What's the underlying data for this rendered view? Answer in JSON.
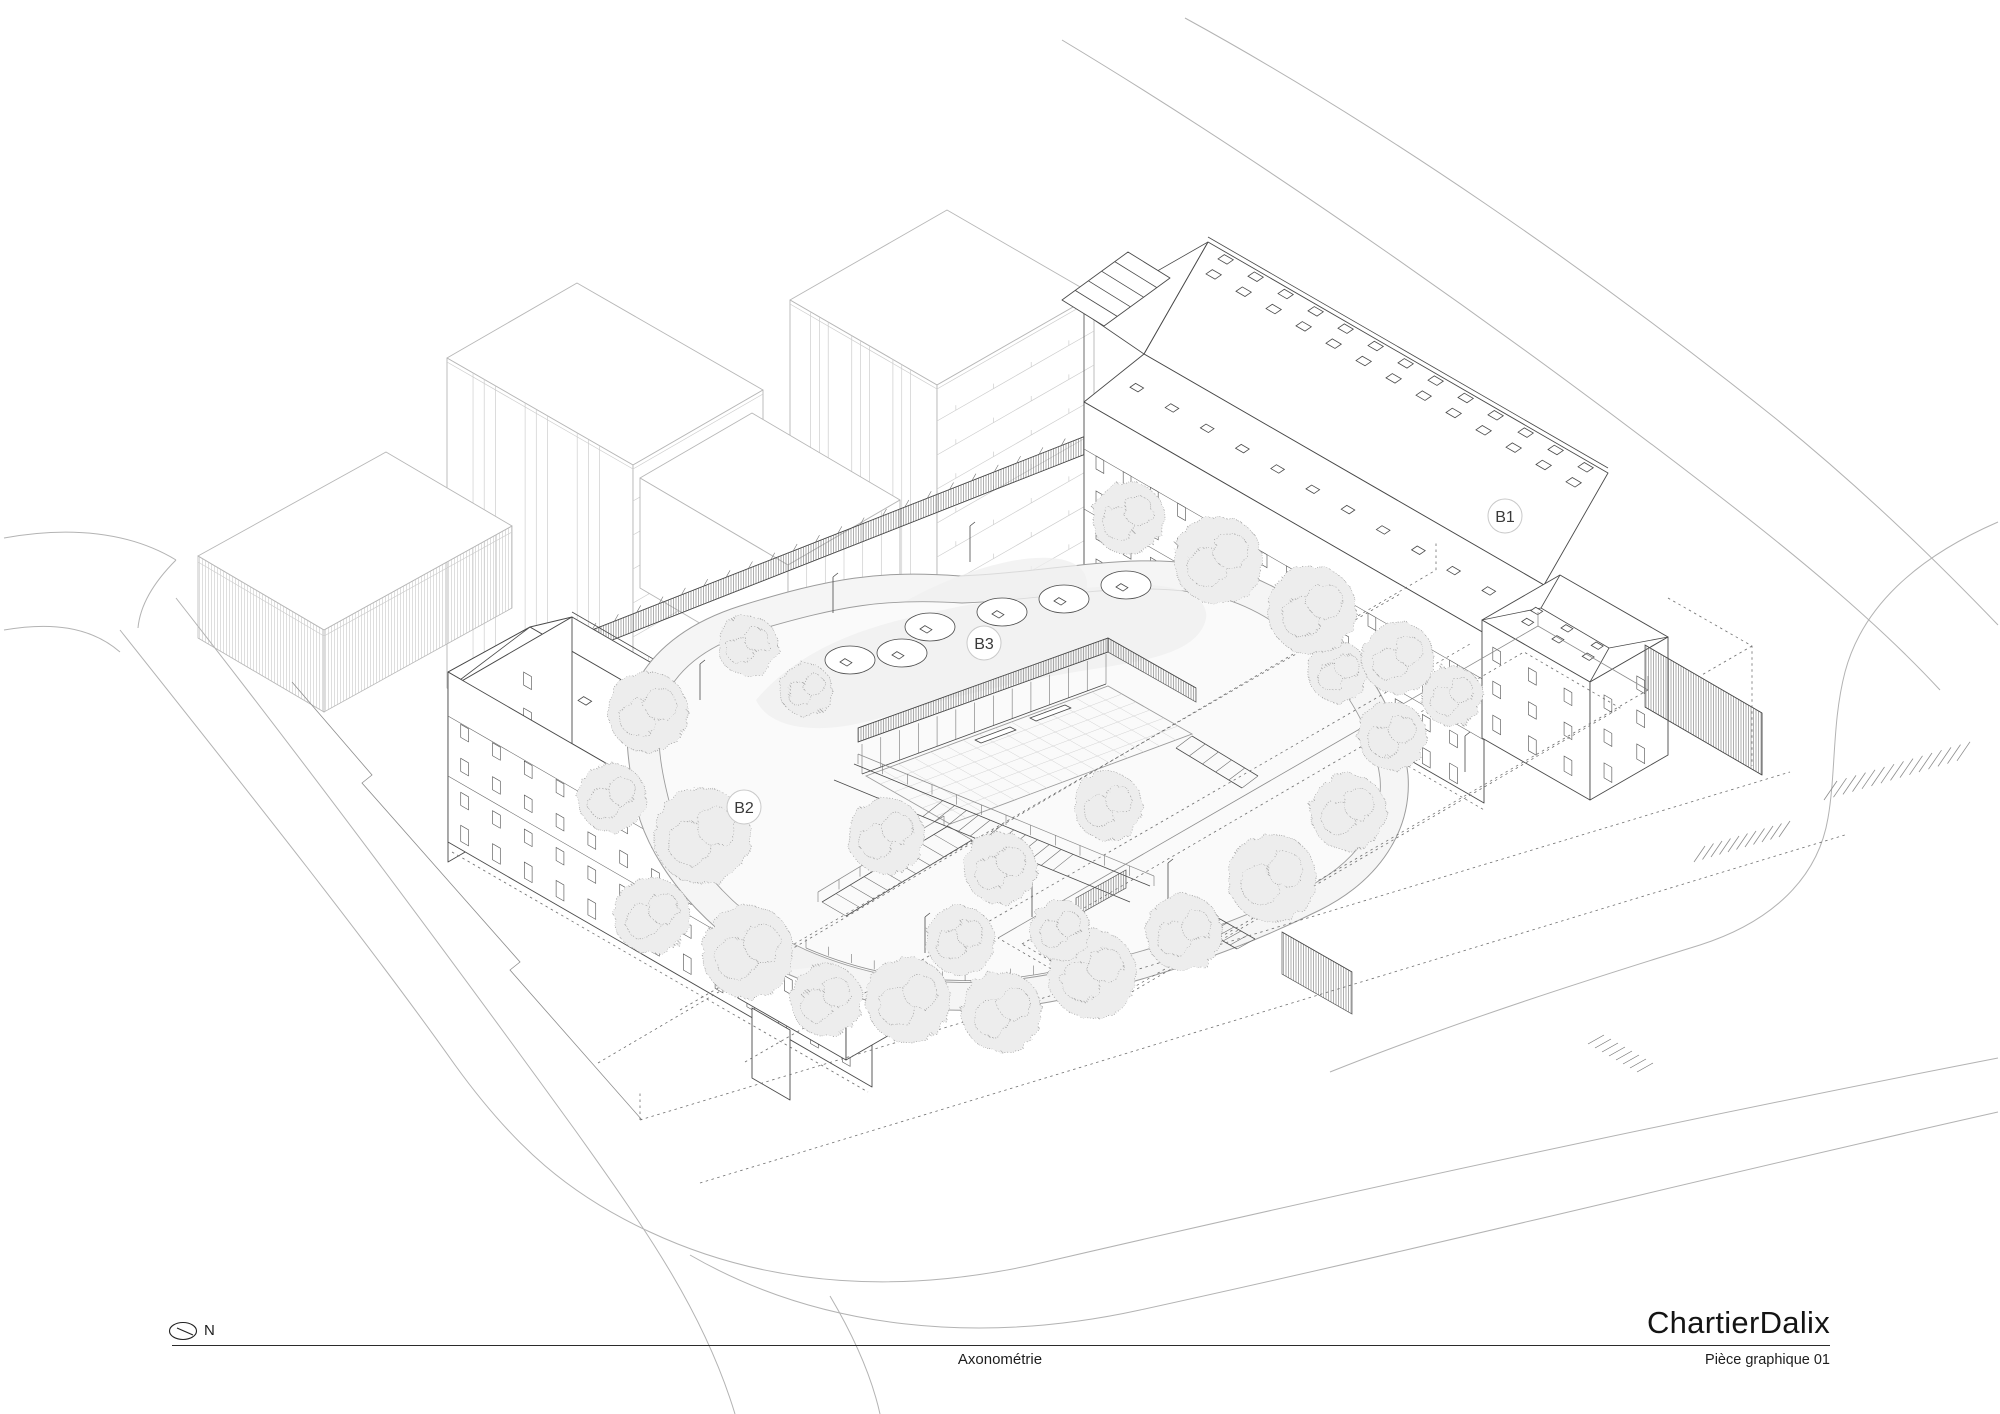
{
  "document": {
    "type": "architectural axonometric drawing"
  },
  "labels": {
    "b1": "B1",
    "b2": "B2",
    "b3": "B3"
  },
  "titleblock": {
    "firm": "ChartierDalix",
    "caption": "Axonométrie",
    "sheet": "Pièce graphique 01",
    "north": "N"
  },
  "colors": {
    "ink": "#4a4a4a",
    "light_ink": "#b7b7b7",
    "paper": "#ffffff",
    "ground": "#f5f5f5",
    "foliage": "#ededed"
  }
}
